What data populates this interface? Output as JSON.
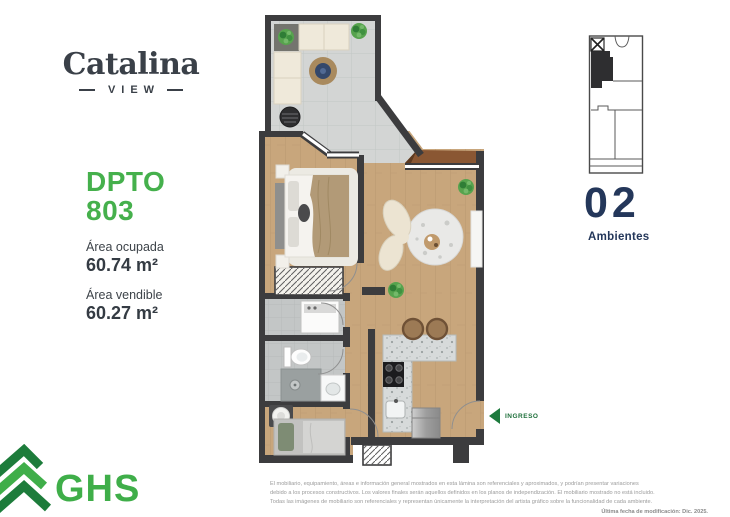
{
  "branding": {
    "title": "Catalina",
    "subtitle": "VIEW"
  },
  "unit": {
    "label": "DPTO",
    "number": "803",
    "areas": [
      {
        "label": "Área ocupada",
        "value": "60.74 m²"
      },
      {
        "label": "Área vendible",
        "value": "60.27 m²"
      }
    ]
  },
  "key_plan": {
    "count": "02",
    "count_label": "Ambientes"
  },
  "floor_plan": {
    "entrance_label": "INGRESO",
    "rooms": [
      "terraza",
      "dormitorio principal",
      "sala",
      "kitchenette",
      "baño",
      "lavandería",
      "dormitorio 2",
      "ingreso"
    ]
  },
  "footer": {
    "company": "GHS",
    "disclaimer": [
      "El mobiliario, equipamiento, áreas e información general mostrados en esta lámina son referenciales y aproximados, y podrían presentar variaciones",
      "debido a los procesos constructivos. Los valores finales serán aquellos definidos en los planos de independización. El mobiliario mostrado no está incluido.",
      "Todas las imágenes de mobiliario son referenciales y representan únicamente la interpretación del artista gráfico sobre la funcionalidad de cada ambiente."
    ],
    "last_update": "Última fecha de modificación: Dic. 2025."
  },
  "colors": {
    "accent_green": "#45b04c",
    "ghs_green": "#3fae49",
    "dark_green": "#1d7a3d",
    "navy": "#24375a",
    "logo_ink": "#3a4048",
    "wall": "#3c3c3e",
    "wood_floor": "#c8a67c",
    "terrace_tile": "#d3d5d4",
    "bath_tile": "#c3c6c6"
  }
}
